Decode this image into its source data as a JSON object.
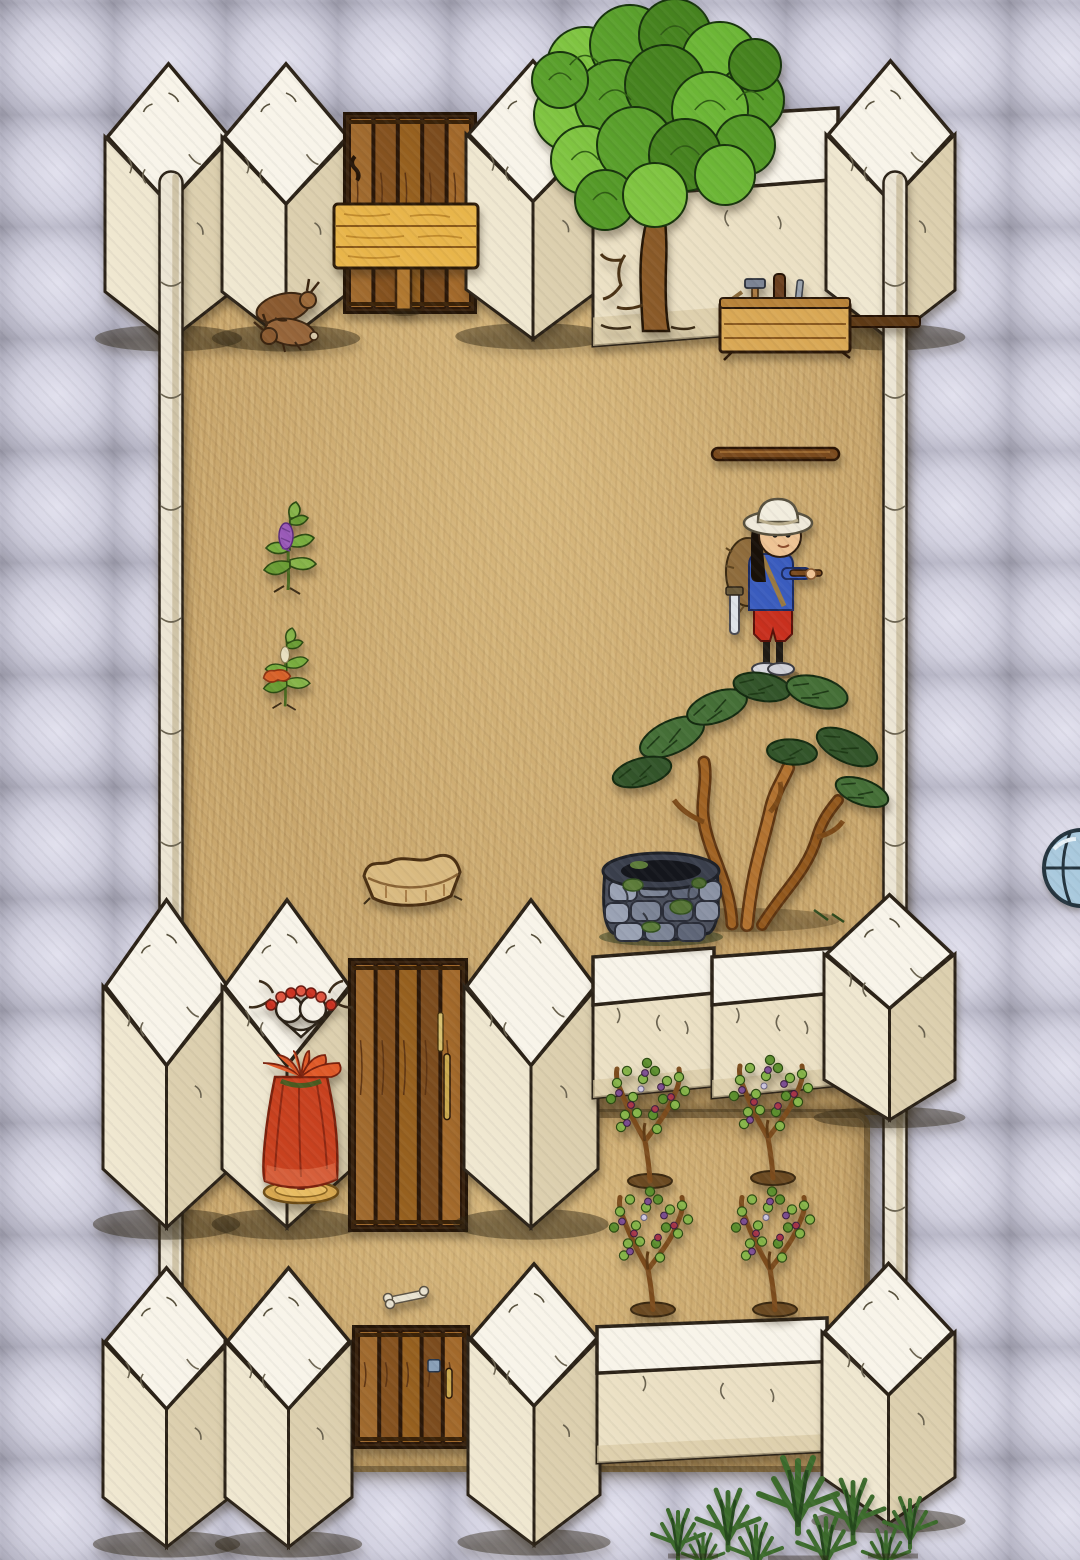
{
  "meta": {
    "title": "Hand-drawn walled compound game scene",
    "canvas": {
      "width": 1080,
      "height": 1560
    }
  },
  "palette": {
    "stone_tile": "#b4b3c3",
    "stone_gap": "#34343d",
    "stone_highlight": "#e2e1ee",
    "wall_top": "#f8f4e9",
    "wall_face": "#ece2c8",
    "wall_shade": "#dccfae",
    "wall_outline": "#2b2217",
    "dirt": "#c9a76d",
    "door_wood": "#8a5622",
    "sign_wood": "#e8b54a",
    "maple_green": "#5aa02c",
    "juniper_green": "#456f37",
    "grape_purple": "#7d4f92",
    "dress_red": "#c8411f",
    "shirt_blue": "#3a5cbe",
    "shorts_red": "#c8301e",
    "hat_cream": "#efe9da"
  },
  "floor": {
    "stone": {
      "label": "grey stone paving",
      "tile_size": 112
    },
    "dirt_rooms": [
      {
        "id": "dirt-floor-upper-room",
        "label": "upper courtyard dirt floor",
        "x": 168,
        "y": 162,
        "w": 734,
        "h": 953
      },
      {
        "id": "dirt-floor-lower-room",
        "label": "lower courtyard dirt floor",
        "x": 168,
        "y": 1112,
        "w": 702,
        "h": 360
      }
    ]
  },
  "walls": [
    {
      "id": "wall-pillar-nw-1",
      "type": "pillar",
      "label": "adobe wall pillar",
      "x": 105,
      "y": 58,
      "w": 127,
      "h": 292
    },
    {
      "id": "wall-pillar-nw-2",
      "type": "pillar",
      "label": "adobe wall pillar",
      "x": 222,
      "y": 58,
      "w": 128,
      "h": 292
    },
    {
      "id": "door-north",
      "type": "door",
      "label": "wooden plank door",
      "x": 343,
      "y": 112,
      "w": 134,
      "h": 202,
      "handle": "left"
    },
    {
      "id": "wall-pillar-n-3",
      "type": "pillar",
      "label": "adobe wall pillar",
      "x": 466,
      "y": 55,
      "w": 134,
      "h": 293
    },
    {
      "id": "wall-flat-north",
      "type": "flatwall",
      "label": "adobe wall segment",
      "x": 593,
      "y": 108,
      "w": 245,
      "h": 238
    },
    {
      "id": "wall-pillar-ne",
      "type": "pillar",
      "label": "adobe corner pillar",
      "x": 826,
      "y": 55,
      "w": 129,
      "h": 294
    },
    {
      "id": "wall-pole-west",
      "type": "pole",
      "label": "thin wall running south",
      "x": 158,
      "y": 170,
      "w": 26,
      "h": 1162
    },
    {
      "id": "wall-pole-east-upper",
      "type": "pole",
      "label": "thin wall running south",
      "x": 882,
      "y": 170,
      "w": 26,
      "h": 852
    },
    {
      "id": "wall-pole-east-lower",
      "type": "pole",
      "label": "thin wall running south",
      "x": 882,
      "y": 1095,
      "w": 26,
      "h": 196
    },
    {
      "id": "wall-pillar-mw-1",
      "type": "pillar",
      "label": "adobe wall pillar",
      "x": 103,
      "y": 893,
      "w": 127,
      "h": 345
    },
    {
      "id": "wall-pillar-mw-2",
      "type": "pillar",
      "label": "adobe wall pillar",
      "x": 222,
      "y": 893,
      "w": 130,
      "h": 345
    },
    {
      "id": "door-middle",
      "type": "door",
      "label": "wooden plank door with key",
      "x": 348,
      "y": 958,
      "w": 120,
      "h": 274,
      "handle": "right",
      "key": true
    },
    {
      "id": "wall-pillar-m-3",
      "type": "pillar",
      "label": "adobe wall pillar",
      "x": 464,
      "y": 893,
      "w": 134,
      "h": 345
    },
    {
      "id": "wall-flat-middle-1",
      "type": "flatwall",
      "label": "adobe wall segment",
      "x": 593,
      "y": 948,
      "w": 121,
      "h": 150
    },
    {
      "id": "wall-flat-middle-2",
      "type": "flatwall",
      "label": "adobe wall segment",
      "x": 712,
      "y": 948,
      "w": 122,
      "h": 150
    },
    {
      "id": "wall-pillar-me",
      "type": "pillar",
      "label": "adobe corner pillar",
      "x": 824,
      "y": 890,
      "w": 131,
      "h": 237
    },
    {
      "id": "wall-pillar-sw-1",
      "type": "pillar",
      "label": "adobe wall pillar",
      "x": 103,
      "y": 1262,
      "w": 127,
      "h": 294
    },
    {
      "id": "wall-pillar-sw-2",
      "type": "pillar",
      "label": "adobe wall pillar",
      "x": 225,
      "y": 1262,
      "w": 127,
      "h": 294
    },
    {
      "id": "door-south",
      "type": "door",
      "label": "wooden plank door with lock plate",
      "x": 352,
      "y": 1325,
      "w": 118,
      "h": 124,
      "handle": "right",
      "plate": true
    },
    {
      "id": "wall-pillar-s-3",
      "type": "pillar",
      "label": "adobe wall pillar",
      "x": 468,
      "y": 1258,
      "w": 132,
      "h": 296
    },
    {
      "id": "wall-flat-south",
      "type": "flatwall",
      "label": "adobe wall segment",
      "x": 597,
      "y": 1318,
      "w": 230,
      "h": 145
    },
    {
      "id": "wall-pillar-se",
      "type": "pillar",
      "label": "adobe corner pillar",
      "x": 822,
      "y": 1258,
      "w": 133,
      "h": 274
    }
  ],
  "objects": [
    {
      "id": "maple-tree",
      "type": "maple",
      "label": "large leafy tree",
      "x": 525,
      "y": 5,
      "w": 255,
      "h": 330
    },
    {
      "id": "toolbox-bench",
      "type": "toolbox",
      "label": "wooden toolbox with hammer and tools",
      "x": 712,
      "y": 272,
      "w": 212,
      "h": 86
    },
    {
      "id": "blank-sign",
      "type": "sign",
      "label": "blank wooden sign on post",
      "x": 330,
      "y": 200,
      "w": 152,
      "h": 120
    },
    {
      "id": "rabbit-carcasses",
      "type": "rabbits",
      "label": "pair of rabbits by the wall",
      "x": 235,
      "y": 272,
      "w": 115,
      "h": 82
    },
    {
      "id": "wooden-shaft",
      "type": "shaft",
      "label": "wooden shaft lying on ground",
      "x": 708,
      "y": 440,
      "w": 135,
      "h": 28
    },
    {
      "id": "purple-flower-plant",
      "type": "plant",
      "label": "plant with purple blossom",
      "color": "purple",
      "x": 248,
      "y": 483,
      "w": 80,
      "h": 112
    },
    {
      "id": "orange-flower-plant",
      "type": "plant",
      "label": "plant with orange blossom",
      "color": "orange",
      "x": 244,
      "y": 612,
      "w": 82,
      "h": 98
    },
    {
      "id": "player-character",
      "type": "character",
      "label": "villager with sun hat, backpack and sword",
      "x": 718,
      "y": 492,
      "w": 105,
      "h": 190
    },
    {
      "id": "juniper-tree",
      "type": "juniper",
      "label": "twisted juniper tree",
      "x": 612,
      "y": 632,
      "w": 268,
      "h": 305
    },
    {
      "id": "stone-well",
      "type": "well",
      "label": "mossy stone well",
      "x": 595,
      "y": 835,
      "w": 132,
      "h": 112
    },
    {
      "id": "old-basket",
      "type": "basket",
      "label": "empty slumped basket",
      "x": 358,
      "y": 846,
      "w": 108,
      "h": 64
    },
    {
      "id": "blue-orb",
      "type": "orb",
      "label": "blue round object at screen edge",
      "x": 1040,
      "y": 825,
      "w": 40,
      "h": 86
    },
    {
      "id": "mannequin-red-dress",
      "type": "mannequin",
      "label": "red rose dress on display stand",
      "x": 235,
      "y": 985,
      "w": 132,
      "h": 230
    },
    {
      "id": "grapevine-1",
      "type": "grapevine",
      "label": "grapevine with grapes",
      "x": 597,
      "y": 1053,
      "w": 106,
      "h": 135
    },
    {
      "id": "grapevine-2",
      "type": "grapevine",
      "label": "grapevine with grapes",
      "x": 720,
      "y": 1050,
      "w": 106,
      "h": 135
    },
    {
      "id": "grapevine-3",
      "type": "grapevine",
      "label": "grapevine with grapes",
      "x": 600,
      "y": 1180,
      "w": 106,
      "h": 138
    },
    {
      "id": "grapevine-4",
      "type": "grapevine",
      "label": "grapevine with grapes",
      "x": 722,
      "y": 1180,
      "w": 106,
      "h": 138
    },
    {
      "id": "bone",
      "type": "bone",
      "label": "bone on the ground",
      "x": 380,
      "y": 1283,
      "w": 52,
      "h": 28
    },
    {
      "id": "evergreen-sapling",
      "type": "sapling",
      "label": "evergreen shoots at bottom edge",
      "x": 648,
      "y": 1452,
      "w": 312,
      "h": 108
    }
  ]
}
